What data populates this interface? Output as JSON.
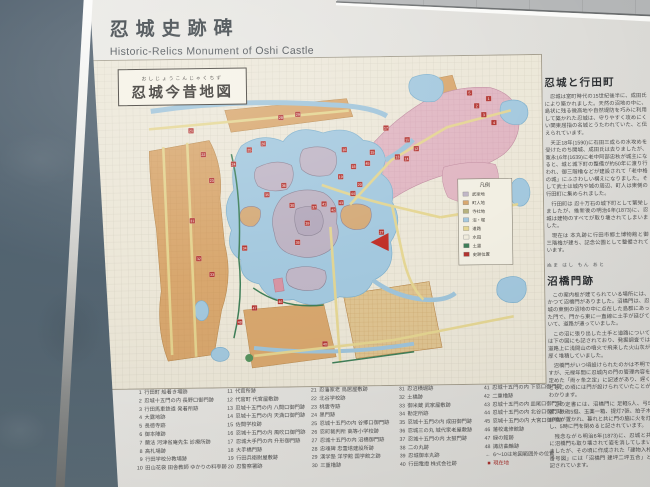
{
  "sign": {
    "title": "忍城史跡碑",
    "subtitle": "Historic-Relics Monument of Oshi Castle"
  },
  "map": {
    "furigana": "おしじょうこんじゃくちず",
    "title": "忍城今昔地図",
    "legend": {
      "title": "凡例",
      "rows": [
        {
          "label": "武家地",
          "color": "#c0b6c6"
        },
        {
          "label": "町人地",
          "color": "#d8a76e"
        },
        {
          "label": "寺社地",
          "color": "#b7b27c"
        },
        {
          "label": "沼・堀",
          "color": "#a3c8de"
        },
        {
          "label": "道路",
          "color": "#e5d691"
        },
        {
          "label": "水田",
          "color": "#f0ecdd"
        },
        {
          "label": "土塁",
          "color": "#3f7f58"
        },
        {
          "label": "史跡位置",
          "color": "#b23430"
        }
      ]
    },
    "markers": [
      {
        "n": 1,
        "x": 398,
        "y": 44
      },
      {
        "n": 2,
        "x": 386,
        "y": 51
      },
      {
        "n": 3,
        "x": 393,
        "y": 60
      },
      {
        "n": 4,
        "x": 403,
        "y": 68
      },
      {
        "n": 5,
        "x": 379,
        "y": 38
      },
      {
        "n": 11,
        "x": 316,
        "y": 84
      },
      {
        "n": 12,
        "x": 325,
        "y": 93
      },
      {
        "n": 13,
        "x": 306,
        "y": 101
      },
      {
        "n": 14,
        "x": 315,
        "y": 103
      },
      {
        "n": 15,
        "x": 281,
        "y": 96
      },
      {
        "n": 16,
        "x": 253,
        "y": 93
      },
      {
        "n": 17,
        "x": 295,
        "y": 72
      },
      {
        "n": 18,
        "x": 262,
        "y": 110
      },
      {
        "n": 19,
        "x": 249,
        "y": 120
      },
      {
        "n": 20,
        "x": 268,
        "y": 128
      },
      {
        "n": 21,
        "x": 100,
        "y": 72
      },
      {
        "n": 22,
        "x": 112,
        "y": 96
      },
      {
        "n": 23,
        "x": 120,
        "y": 122
      },
      {
        "n": 24,
        "x": 142,
        "y": 106
      },
      {
        "n": 25,
        "x": 158,
        "y": 92
      },
      {
        "n": 26,
        "x": 172,
        "y": 86
      },
      {
        "n": 27,
        "x": 289,
        "y": 176
      },
      {
        "n": 28,
        "x": 190,
        "y": 60
      },
      {
        "n": 29,
        "x": 207,
        "y": 57
      },
      {
        "n": 30,
        "x": 200,
        "y": 148
      },
      {
        "n": 31,
        "x": 100,
        "y": 162
      },
      {
        "n": 32,
        "x": 106,
        "y": 200
      },
      {
        "n": 33,
        "x": 119,
        "y": 216
      },
      {
        "n": 34,
        "x": 152,
        "y": 190
      },
      {
        "n": 35,
        "x": 175,
        "y": 137
      },
      {
        "n": 36,
        "x": 192,
        "y": 128
      },
      {
        "n": 37,
        "x": 222,
        "y": 150
      },
      {
        "n": 38,
        "x": 205,
        "y": 185
      },
      {
        "n": 39,
        "x": 215,
        "y": 166
      },
      {
        "n": 40,
        "x": 231,
        "y": 287
      },
      {
        "n": 41,
        "x": 232,
        "y": 147
      },
      {
        "n": 42,
        "x": 241,
        "y": 153
      },
      {
        "n": 43,
        "x": 249,
        "y": 146
      },
      {
        "n": 44,
        "x": 261,
        "y": 137
      },
      {
        "n": 45,
        "x": 276,
        "y": 107
      },
      {
        "n": 46,
        "x": 187,
        "y": 244
      },
      {
        "n": 47,
        "x": 161,
        "y": 250
      },
      {
        "n": 48,
        "x": 146,
        "y": 264
      }
    ],
    "current_marker_color": "#c03028",
    "marker_color": "#b23430"
  },
  "right_panel": {
    "sections": [
      {
        "heading": "忍城と行田町",
        "furigana": "",
        "paragraphs": [
          "忍城は室町時代の15世紀後半に、成田氏により築かれました。天然の沼地の中に、島状に残る微高地や自然堤防を巧みに利用して築かれた忍城は、守りやすく攻めにくい関東屈指の名城とうたわれていた、と伝えられています。",
          "天正18年(1590)に石田三成らの水攻めを受けたのち開城、成田氏は去りましたが、寛永16年(1639)に老中阿部忠秋が城主になると、城と城下町の整備が約50年に渡り行われ、御三階櫓などが建設されて「老中格の城」にふさわしい構えになりました。そして武士は城内や城の周辺、町人は東側の行田町に集められました。",
          "行田町は 忍十万石の城下町として繁栄しましたが、維新後の明治6年(1873)に、忍城は建物のすべてが取り壊されてしまいました。",
          "現在は 本丸跡に行田市郷土博物館と御三階櫓が建ち、記念公園として整備されています。"
        ]
      },
      {
        "heading": "沼橋門跡",
        "furigana": "ぬま はし もん あと",
        "paragraphs": [
          "この案内板が建てられている場所には、かつて沼橋門がありました。沼橋門は、忍城の東側の沼地の中に点在した島群にあった門で、門から東に一直線に土手が延びていて、道路が通っていました。",
          "この沼に張り出した土手と道路については下の図にも記されており、発掘調査では道路上に浅間山の噴火で飛来した火山灰が厚く堆積していました。",
          "沼橋門がいつ頃設けられたのかは不明ですが、元禄年間に忍城内の門の管理内容を定めた「両ヶ条之定」に記述があり、遅くともこの頃には門が設けられていたことがわかります。",
          "この定書には、沼橋門に 足軽5人、弓5張、鉄砲5挺、玉薬一箱、提灯7張、拍子木10本が置かれ、暮れと共に門の脇に火を灯し、5時に門を閉めると記されています。",
          "残念ながら明治6年(1873)に、忍城と共に沼橋門も取り壊されて姿を消してしまいましたが、その頃に作成された「建物入札番号図」には「沼橋門 建坪二坪五合」と記されています。"
        ]
      }
    ]
  },
  "site_list": {
    "columns": [
      [
        {
          "n": "1",
          "label": "行田町 船着き場跡"
        },
        {
          "n": "2",
          "label": "忍城十五門の内 長野口御門跡"
        },
        {
          "n": "3",
          "label": "行田馬車鉄道 発着所跡"
        },
        {
          "n": "4",
          "label": "大露地跡"
        },
        {
          "n": "5",
          "label": "長徳寺跡"
        },
        {
          "n": "6",
          "label": "御本陣跡"
        },
        {
          "n": "7",
          "label": "蘭法 河津省庵先生 診療所跡"
        },
        {
          "n": "8",
          "label": "高札場跡"
        },
        {
          "n": "9",
          "label": "行田学校分教場跡"
        },
        {
          "n": "10",
          "label": "田山花袋 田舎教師 ゆかりの料亭跡"
        }
      ],
      [
        {
          "n": "11",
          "label": "代官所跡"
        },
        {
          "n": "12",
          "label": "代官町 代官屋敷跡"
        },
        {
          "n": "13",
          "label": "忍城十五門の内 八間口御門跡"
        },
        {
          "n": "14",
          "label": "忍城十五門の内 天満口御門跡"
        },
        {
          "n": "15",
          "label": "佐間学校跡"
        },
        {
          "n": "16",
          "label": "忍城十五門の内 風吹口御門跡"
        },
        {
          "n": "17",
          "label": "忍城大手門の内 升形御門跡"
        },
        {
          "n": "18",
          "label": "大手橋門跡"
        },
        {
          "n": "19",
          "label": "行田兵衛尉屋敷跡"
        },
        {
          "n": "20",
          "label": "忍警察署跡"
        }
      ],
      [
        {
          "n": "21",
          "label": "忍藩家老 鳥居屋敷跡"
        },
        {
          "n": "22",
          "label": "北谷学校跡"
        },
        {
          "n": "23",
          "label": "桃雲寺跡"
        },
        {
          "n": "24",
          "label": "黒門跡"
        },
        {
          "n": "25",
          "label": "忍城十五門の内 谷郷口御門跡"
        },
        {
          "n": "26",
          "label": "忍町裁判所 高等小学校跡"
        },
        {
          "n": "27",
          "label": "忍城十五門の内 沼橋御門跡"
        },
        {
          "n": "28",
          "label": "忠魂碑 忠霊塔建設所跡"
        },
        {
          "n": "29",
          "label": "漢学塾 洋学館 国学館之跡"
        },
        {
          "n": "30",
          "label": "三重櫓跡"
        }
      ],
      [
        {
          "n": "31",
          "label": "忍沼横堀跡"
        },
        {
          "n": "32",
          "label": "土橋跡"
        },
        {
          "n": "33",
          "label": "御米蔵 武家屋敷跡"
        },
        {
          "n": "34",
          "label": "勘定所跡"
        },
        {
          "n": "35",
          "label": "忍城十五門の内 成田御門跡"
        },
        {
          "n": "36",
          "label": "忍城三の丸 城代家老屋敷跡"
        },
        {
          "n": "37",
          "label": "忍城十五門の内 太鼓門跡"
        },
        {
          "n": "38",
          "label": "二の丸跡"
        },
        {
          "n": "39",
          "label": "忍城御本丸跡"
        },
        {
          "n": "40",
          "label": "行田電燈 株式会社跡"
        }
      ],
      [
        {
          "n": "41",
          "label": "忍城十五門の内 下忍口御門跡"
        },
        {
          "n": "42",
          "label": "二重櫓跡"
        },
        {
          "n": "43",
          "label": "忍城十五門の内 皿尾口御門跡"
        },
        {
          "n": "44",
          "label": "忍城十五門の内 北谷口御門跡"
        },
        {
          "n": "45",
          "label": "忍城十五門の内 大宮口御門跡"
        },
        {
          "n": "46",
          "label": "藩校進修館跡"
        },
        {
          "n": "47",
          "label": "緑の館跡"
        },
        {
          "n": "48",
          "label": "諏訪曲輪跡"
        },
        {
          "n": "←",
          "label": "6〜10は地図範囲外の位置"
        },
        {
          "n": "■",
          "label": "現在地",
          "red": true
        }
      ]
    ]
  }
}
